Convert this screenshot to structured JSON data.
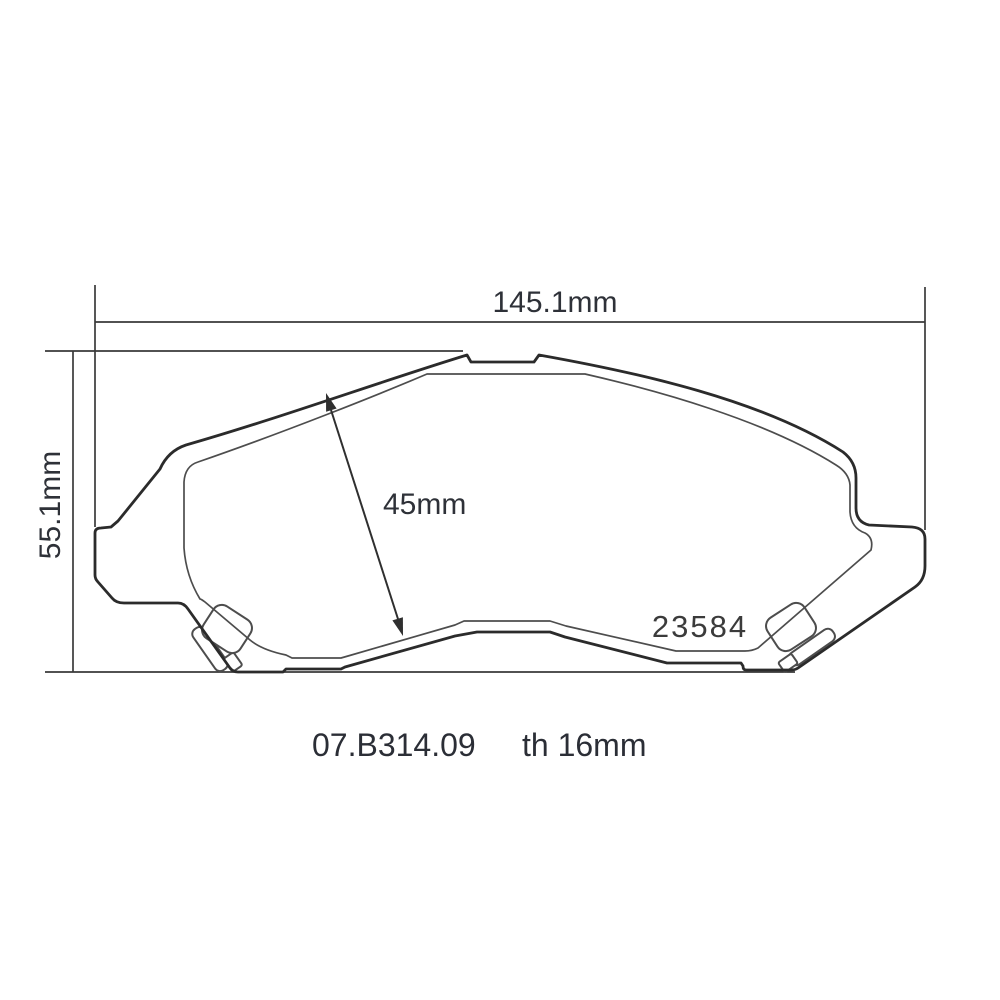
{
  "drawing": {
    "width_dim": "145.1mm",
    "height_dim": "55.1mm",
    "friction_height_dim": "45mm",
    "pad_marking": "23584",
    "part_code": "07.B314.09",
    "thickness_note": "th 16mm"
  },
  "colors": {
    "outline": "#2b2b2b",
    "inner_line": "#4d4d4d",
    "dimension_line": "#3a3a3a",
    "text": "#2e3138",
    "background": "#ffffff"
  }
}
